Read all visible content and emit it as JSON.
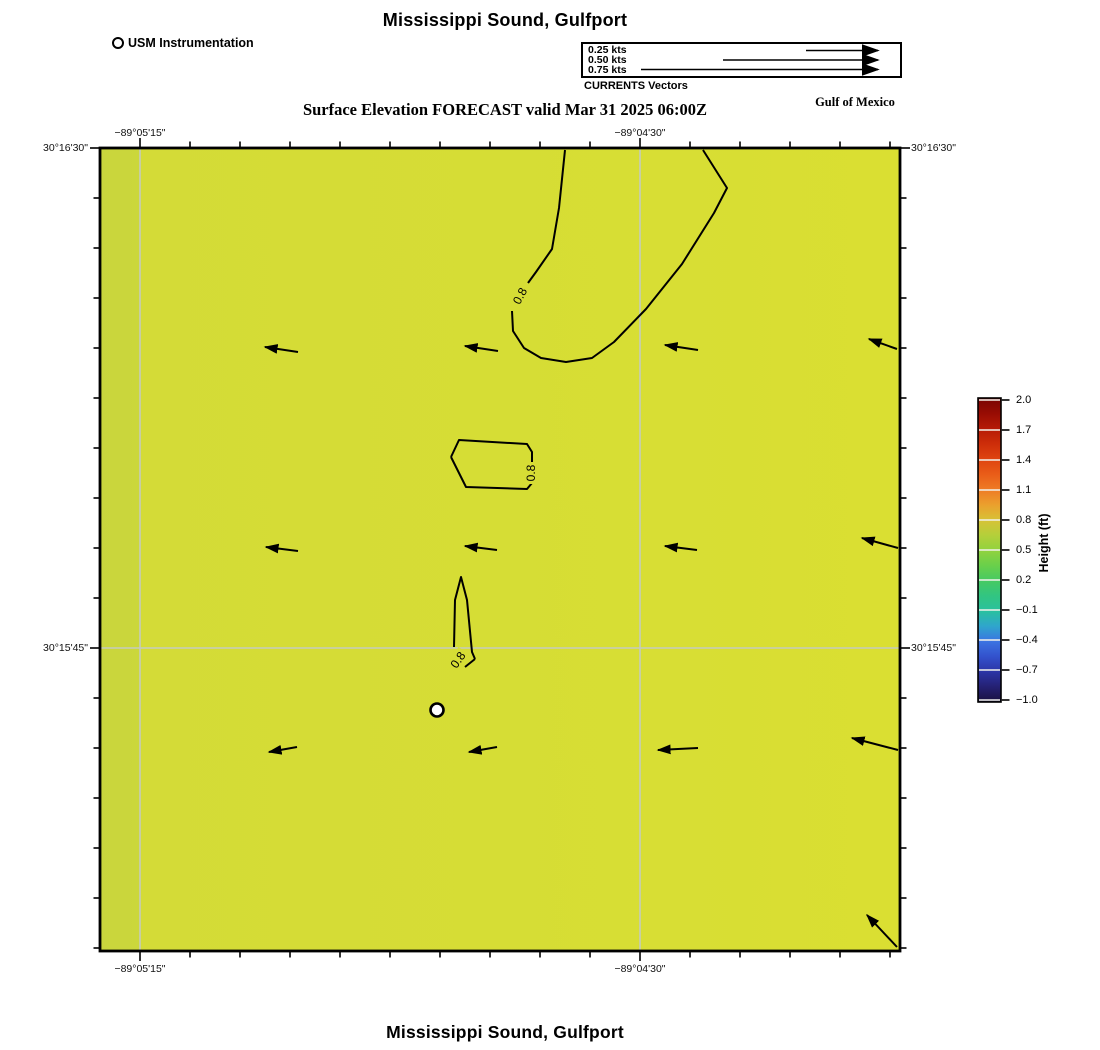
{
  "header": {
    "title": "Mississippi Sound, Gulfport",
    "subtitle": "Surface Elevation FORECAST valid Mar 31 2025 06:00Z",
    "region_label": "Gulf of Mexico"
  },
  "legend": {
    "station_label": "USM Instrumentation",
    "vectors": {
      "caption": "CURRENTS Vectors",
      "items": [
        {
          "label": "0.25 kts"
        },
        {
          "label": "0.50 kts"
        },
        {
          "label": "0.75 kts"
        }
      ]
    }
  },
  "map": {
    "x_axis": {
      "labels": [
        "−89°05'15\"",
        "−89°04'30\""
      ]
    },
    "y_axis": {
      "labels": [
        "30°16'30\"",
        "30°15'45\""
      ]
    },
    "contour_label": "0.8",
    "surface_color": "#d6dd35",
    "grid_color": "#c5ccbd",
    "fill_stops": [
      [
        "0",
        "#c9d53d"
      ],
      [
        "0.048",
        "#cbd73b"
      ],
      [
        "0.052",
        "#d4db37"
      ],
      [
        "0.5",
        "#d6dd35"
      ],
      [
        "1",
        "#dadf32"
      ]
    ]
  },
  "colorbar": {
    "title": "Height (ft)",
    "ticks": [
      "2.0",
      "1.7",
      "1.4",
      "1.1",
      "0.8",
      "0.5",
      "0.2",
      "−0.1",
      "−0.4",
      "−0.7",
      "−1.0"
    ],
    "gradient": [
      [
        "0",
        "#7a0403"
      ],
      [
        "0.05",
        "#970c03"
      ],
      [
        "0.10",
        "#b51a06"
      ],
      [
        "0.15",
        "#cd2d09"
      ],
      [
        "0.20",
        "#de4410"
      ],
      [
        "0.25",
        "#e95c18"
      ],
      [
        "0.30",
        "#ee7a25"
      ],
      [
        "0.35",
        "#eb9f2d"
      ],
      [
        "0.40",
        "#d8c136"
      ],
      [
        "0.45",
        "#b5cf3a"
      ],
      [
        "0.50",
        "#92d23e"
      ],
      [
        "0.55",
        "#6ad04a"
      ],
      [
        "0.60",
        "#47ca62"
      ],
      [
        "0.65",
        "#32c581"
      ],
      [
        "0.70",
        "#2ac19e"
      ],
      [
        "0.75",
        "#2fa6cc"
      ],
      [
        "0.80",
        "#3b74e2"
      ],
      [
        "0.85",
        "#3352cd"
      ],
      [
        "0.90",
        "#2c35a6"
      ],
      [
        "0.95",
        "#252173"
      ],
      [
        "1",
        "#1a1140"
      ]
    ]
  },
  "footer": {
    "title": "Mississippi Sound, Gulfport"
  },
  "chart_data": {
    "type": "heatmap",
    "title": "Mississippi Sound, Gulfport",
    "subtitle": "Surface Elevation FORECAST valid Mar 31 2025 06:00Z",
    "variable": "Surface Elevation",
    "forecast_valid": "Mar 31 2025 06:00Z",
    "region_label": "Gulf of Mexico",
    "x_axis": {
      "type": "longitude",
      "tick_labels": [
        "−89°05'15\"",
        "−89°04'30\""
      ]
    },
    "y_axis": {
      "type": "latitude",
      "tick_labels": [
        "30°16'30\"",
        "30°15'45\""
      ]
    },
    "colorbar": {
      "label": "Height (ft)",
      "min": -1.0,
      "max": 2.0,
      "tick_values": [
        2.0,
        1.7,
        1.4,
        1.1,
        0.8,
        0.5,
        0.2,
        -0.1,
        -0.4,
        -0.7,
        -1.0
      ]
    },
    "field_summary": "Near-uniform surface elevation of approximately 0.7-0.8 ft (yellow-green) across the whole domain",
    "contour_levels_ft": [
      0.8
    ],
    "vectors": {
      "legend_speeds_kts": [
        0.25,
        0.5,
        0.75
      ],
      "caption": "CURRENTS Vectors",
      "direction": "westward; up-left (northwest) along eastern edge",
      "approx_speed_kts": "0.10-0.15"
    },
    "station": {
      "label": "USM Instrumentation",
      "marker": "open circle"
    },
    "render_px": {
      "arrows": [
        [
          298,
          352,
          265,
          347
        ],
        [
          498,
          351,
          465,
          346
        ],
        [
          698,
          350,
          665,
          345
        ],
        [
          897,
          349,
          869,
          339
        ],
        [
          298,
          551,
          266,
          547
        ],
        [
          497,
          550,
          465,
          546
        ],
        [
          697,
          550,
          665,
          546
        ],
        [
          898,
          548,
          862,
          538
        ],
        [
          297,
          747,
          269,
          752
        ],
        [
          497,
          747,
          469,
          752
        ],
        [
          698,
          748,
          658,
          750
        ],
        [
          898,
          750,
          852,
          738
        ],
        [
          897,
          947,
          867,
          915
        ]
      ],
      "legend_arrows": [
        [
          806,
          50.5,
          878,
          50.5
        ],
        [
          723,
          60,
          878,
          60
        ],
        [
          641,
          69.5,
          878,
          69.5
        ]
      ],
      "contours": [
        "M565,150 L559,208 L552,249 L536,272 L528,283",
        "M512,311 L513,331 L524,348 L541,358 L566,362 L592,358 L614,342 L646,309 L682,264 L714,213 L727,188 L703,150",
        "M451,457 L459,440 L527,444 L532,452 L532,462",
        "M532,483 L527,489 L466,487 L451,457",
        "M454,647 L455,600 L461,577 L467,600 L472,652 L475,659",
        "M465,667 L475,659"
      ],
      "contour_labels": [
        {
          "x": 520,
          "y": 296,
          "rot": -62
        },
        {
          "x": 531,
          "y": 473,
          "rot": -90
        },
        {
          "x": 458,
          "y": 660,
          "rot": -55
        }
      ],
      "station_marker": {
        "x": 437,
        "y": 710,
        "r": 6.5
      }
    }
  }
}
